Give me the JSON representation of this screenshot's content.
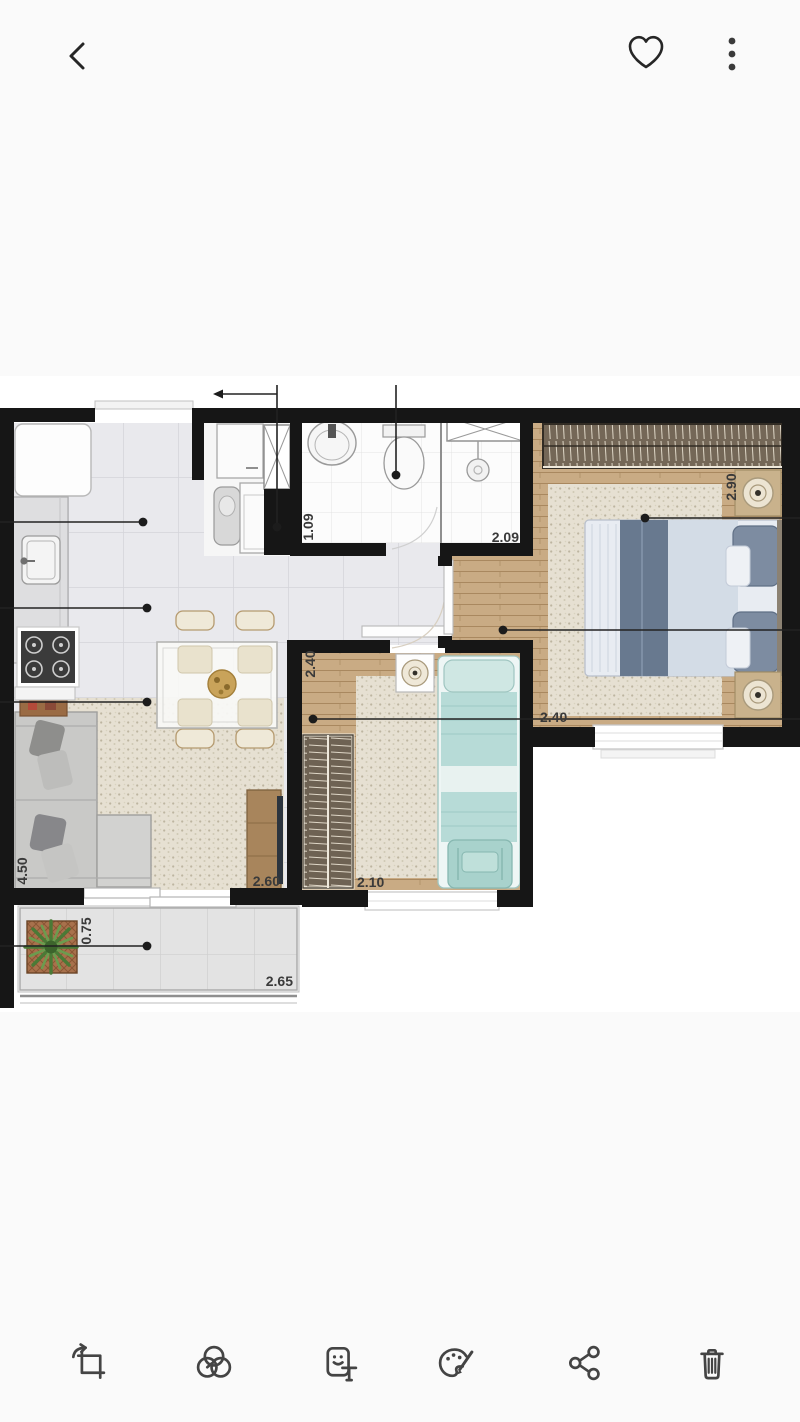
{
  "screen": {
    "type": "photo-viewer",
    "subject": "apartment-floor-plan"
  },
  "top_bar": {
    "icons": [
      {
        "id": "back",
        "glyph": "chevron-left"
      },
      {
        "id": "favorite",
        "glyph": "heart-outline"
      },
      {
        "id": "more-options",
        "glyph": "vertical-ellipsis"
      }
    ]
  },
  "photo": {
    "description": "2D apartment floor plan with kitchen, living-dining room, bathroom, laundry nook, two bedrooms and balcony",
    "dimension_labels": [
      {
        "text": "1.09",
        "orientation": "vertical"
      },
      {
        "text": "2.09",
        "orientation": "horizontal"
      },
      {
        "text": "2.90",
        "orientation": "vertical"
      },
      {
        "text": "2.40",
        "orientation": "vertical"
      },
      {
        "text": "2.40",
        "orientation": "horizontal"
      },
      {
        "text": "2.60",
        "orientation": "horizontal"
      },
      {
        "text": "2.10",
        "orientation": "horizontal"
      },
      {
        "text": "4.50",
        "orientation": "vertical"
      },
      {
        "text": "0.75",
        "orientation": "vertical"
      },
      {
        "text": "2.65",
        "orientation": "horizontal"
      }
    ]
  },
  "bottom_toolbar": {
    "icons": [
      {
        "id": "crop-rotate"
      },
      {
        "id": "effects"
      },
      {
        "id": "sticker-text"
      },
      {
        "id": "draw-decorate"
      },
      {
        "id": "share"
      },
      {
        "id": "delete"
      }
    ]
  },
  "colors": {
    "background": "#fafafa",
    "icon": "#3f3f3f",
    "wall": "#161616",
    "wood_floor": "#c9ab84",
    "rug": "#e5dfd2",
    "teal_bed": "#b7dbd7",
    "label_text": "#3a3a3a"
  }
}
